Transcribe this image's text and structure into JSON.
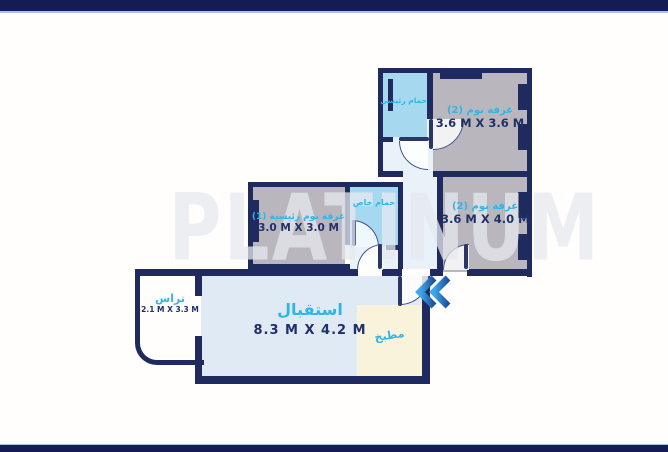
{
  "watermark": "PLATINUM",
  "colors": {
    "wall_navy": "#1f2a5e",
    "frame_bar": "#151c55",
    "label_cyan": "#31b4e9",
    "dims_navy": "#20306a",
    "room_gray": "#b9b6bd",
    "bathroom_blue": "#a6d9ef",
    "hall_light": "#e9f1f9",
    "reception_blue": "#dfeaf5",
    "kitchen_cream": "#faf3db",
    "chevron_blue": "#2b6fd0"
  },
  "rooms": {
    "bedroom_top": {
      "name": "غرفة نوم (2)",
      "dims": "3.6 M X 3.6 M"
    },
    "bedroom_right": {
      "name": "غرفة نوم (2)",
      "dims": "3.6 M X 4.0 M"
    },
    "master_bedroom": {
      "name": "غرفة نوم رئيسية (1)",
      "dims": "3.0 M X 3.0 M"
    },
    "main_bathroom": {
      "name": "حمام رئيسي"
    },
    "private_bathroom": {
      "name": "حمام خاص"
    },
    "reception": {
      "name": "استقبال",
      "dims": "8.3 M X 4.2 M"
    },
    "kitchen": {
      "name": "مطبخ"
    },
    "terrace": {
      "name": "تراس",
      "dims": "2.1 M X 3.3 M"
    }
  },
  "entrance": {
    "icon": "double-chevron-left"
  }
}
